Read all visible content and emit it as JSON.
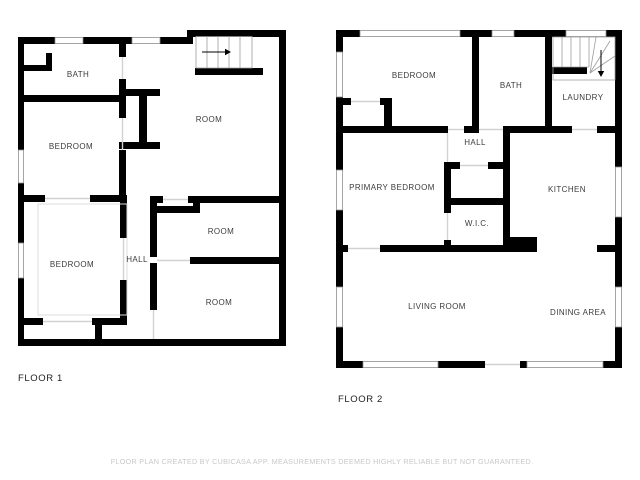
{
  "floor1": {
    "label": "FLOOR 1",
    "rooms": [
      {
        "name": "BATH"
      },
      {
        "name": "BEDROOM"
      },
      {
        "name": "BEDROOM"
      },
      {
        "name": "HALL"
      },
      {
        "name": "ROOM"
      },
      {
        "name": "ROOM"
      },
      {
        "name": "ROOM"
      }
    ]
  },
  "floor2": {
    "label": "FLOOR 2",
    "rooms": [
      {
        "name": "BEDROOM"
      },
      {
        "name": "BATH"
      },
      {
        "name": "LAUNDRY"
      },
      {
        "name": "HALL"
      },
      {
        "name": "PRIMARY BEDROOM"
      },
      {
        "name": "KITCHEN"
      },
      {
        "name": "W.I.C."
      },
      {
        "name": "LIVING ROOM"
      },
      {
        "name": "DINING AREA"
      }
    ]
  },
  "footer": {
    "disclaimer": "FLOOR PLAN CREATED BY CUBICASA APP. MEASUREMENTS DEEMED HIGHLY RELIABLE BUT NOT GUARANTEED."
  },
  "colors": {
    "wall": "#000000",
    "window_frame": "#8f8f8f",
    "door": "#d2d2d2",
    "room_text": "#3c3c3c",
    "footer_text": "#c8c8c8"
  }
}
